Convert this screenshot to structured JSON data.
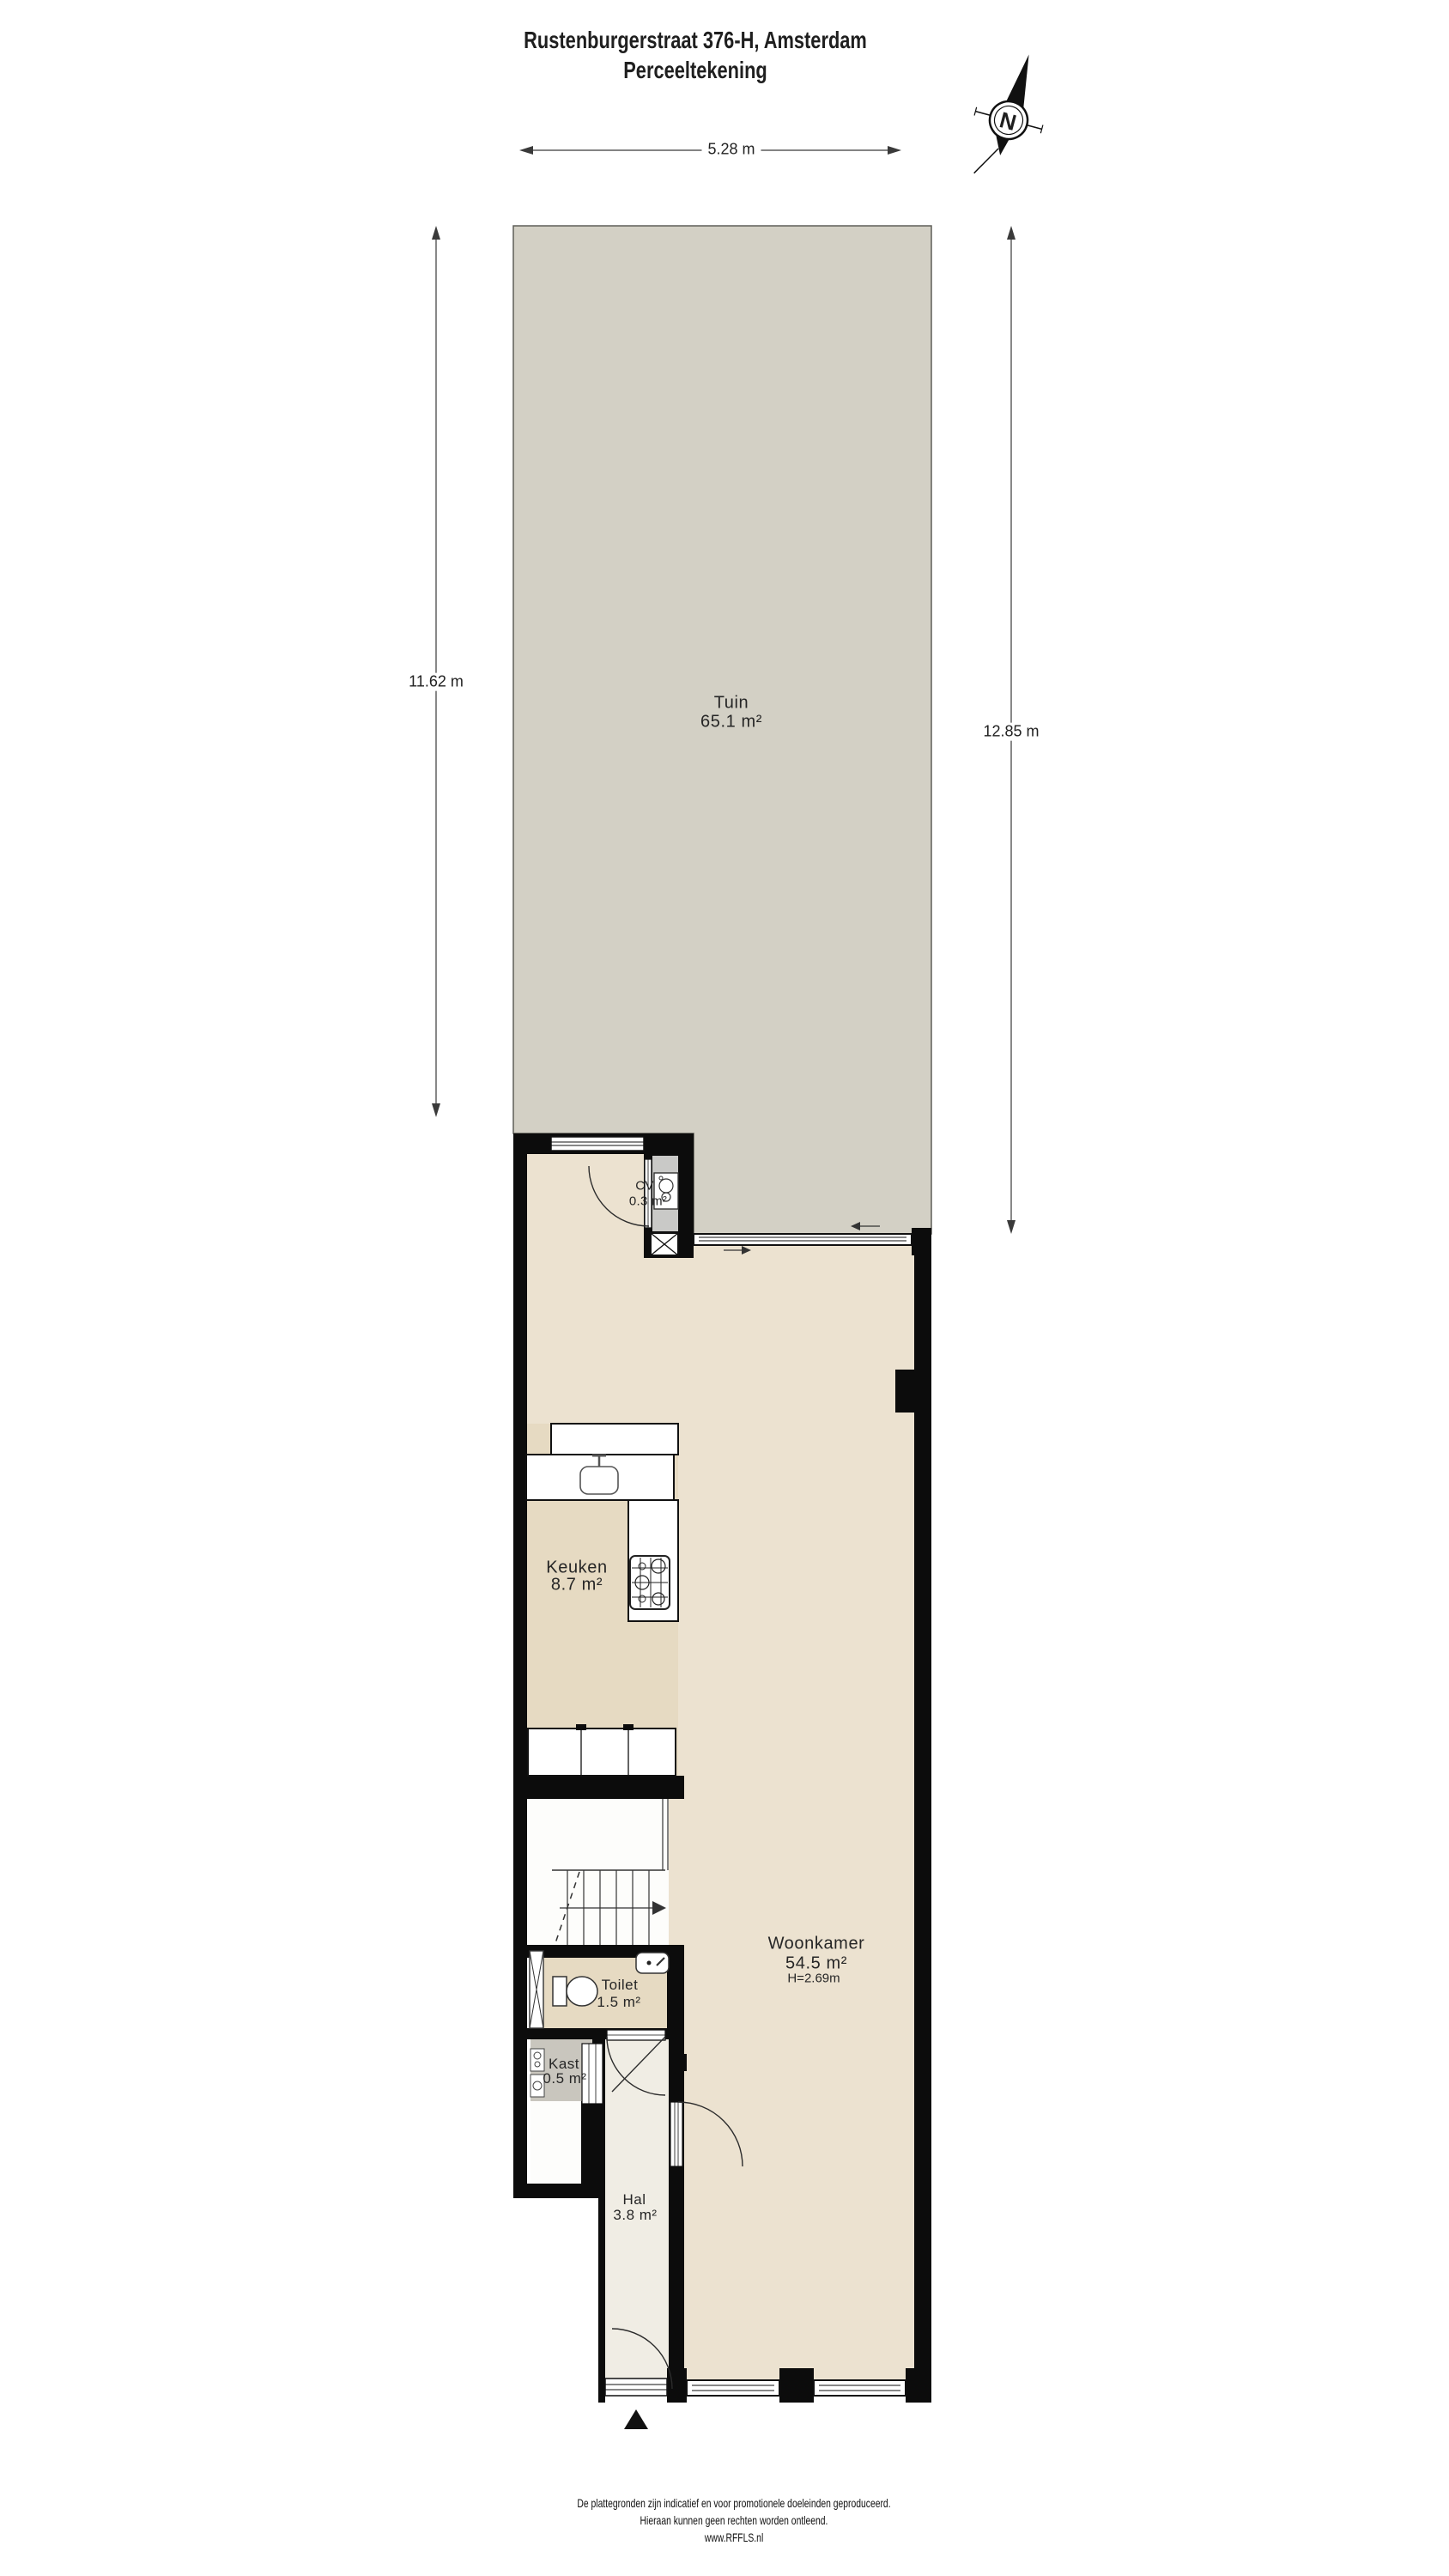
{
  "title": {
    "line1": "Rustenburgerstraat 376-H, Amsterdam",
    "line2": "Perceeltekening"
  },
  "compass": {
    "north_label": "N"
  },
  "dimensions": {
    "top": "5.28 m",
    "left": "11.62 m",
    "right": "12.85 m"
  },
  "rooms": {
    "tuin": {
      "name": "Tuin",
      "area": "65.1 m²"
    },
    "cv": {
      "name": "CV",
      "area": "0.3 m²"
    },
    "keuken": {
      "name": "Keuken",
      "area": "8.7 m²"
    },
    "woonkamer": {
      "name": "Woonkamer",
      "area": "54.5 m²",
      "ceiling_height": "H=2.69m"
    },
    "toilet": {
      "name": "Toilet",
      "area": "1.5 m²"
    },
    "kast": {
      "name": "Kast",
      "area": "0.5 m²"
    },
    "hal": {
      "name": "Hal",
      "area": "3.8 m²"
    }
  },
  "footer": {
    "line1": "De plattegronden zijn indicatief en voor promotionele doeleinden geproduceerd.",
    "line2": "Hieraan kunnen geen rechten worden ontleend.",
    "line3": "www.RFFLS.nl"
  },
  "icons": {
    "compass": "north-compass-rose",
    "entrance_marker": "black-triangle-up",
    "stair_direction": "arrow-right",
    "sliding_door": "arrows-left-right"
  },
  "colors": {
    "garden_fill": "#d3d0c5",
    "garden_border": "#5f5f58",
    "living_floor": "#ece2d0",
    "kitchen_toilet_floor": "#e6dac2",
    "hall_floor": "#f0ede4",
    "closet_fill": "#c9c6be",
    "cv_niche": "#c9c9c7",
    "wall": "#0c0c0c",
    "line": "#3a3a3a"
  }
}
